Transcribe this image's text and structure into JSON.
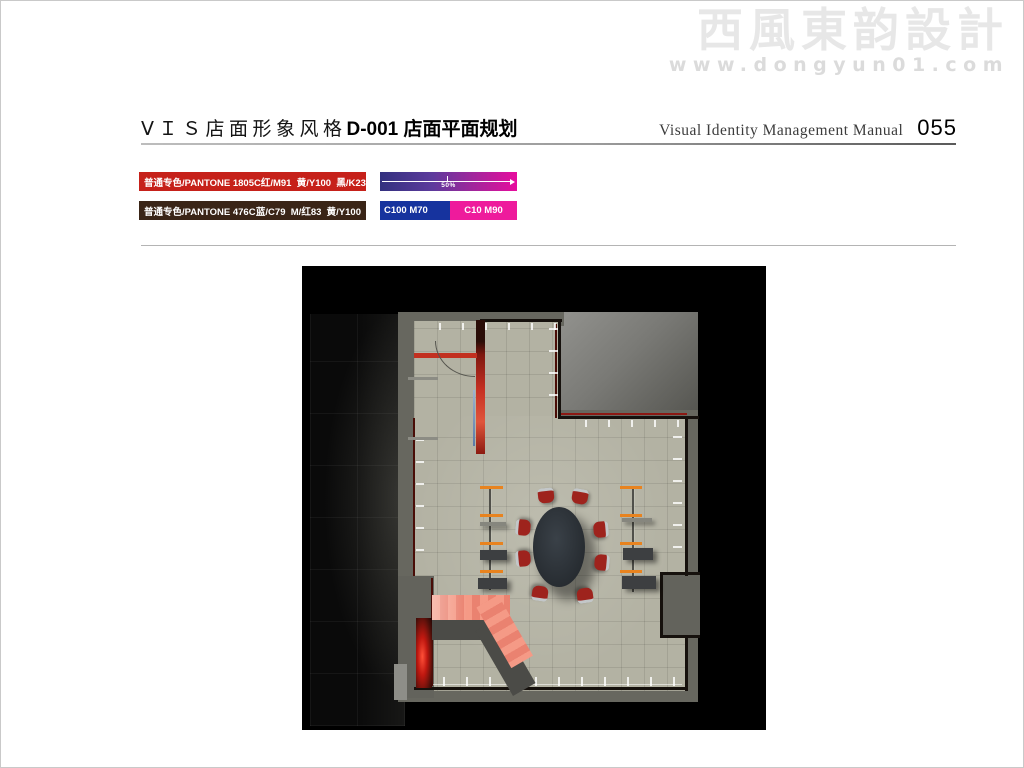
{
  "watermark": {
    "logo": "西風東韵設計",
    "url": "www.dongyun01.com"
  },
  "header": {
    "section_title_cn": "ⅤＩＳ店面形象风格",
    "page_title_cn": "D-001 店面平面规划",
    "manual_title_en": "Visual Identity Management Manual",
    "page_number": "055"
  },
  "color_specs": {
    "spot1": {
      "label": "普通专色/PANTONE 1805C",
      "values": "红/M91  黄/Y100  黑/K23",
      "hex": "#c6211a"
    },
    "spot2": {
      "label": "普通专色/PANTONE 476C",
      "values": "蓝/C79  M/红83  黄/Y100",
      "hex": "#3a2517"
    },
    "gradient": {
      "midpoint_label": "50%",
      "from_hex": "#33317f",
      "to_hex": "#e70d9d"
    },
    "duotone": {
      "left_label": "C100 M70",
      "left_hex": "#16339e",
      "right_label": "C10 M90",
      "right_hex": "#ee1b9c"
    }
  },
  "floorplan": {
    "colors": {
      "floor": "#b3b2a3",
      "wall_gray": "#67675f",
      "accent_red": "#c23020",
      "rack_orange": "#e8831f",
      "ramp_salmon": "#ef8e7b",
      "table_dark": "#2e343a",
      "chair_red": "#9e231d",
      "glow_red": "#d42415"
    }
  }
}
